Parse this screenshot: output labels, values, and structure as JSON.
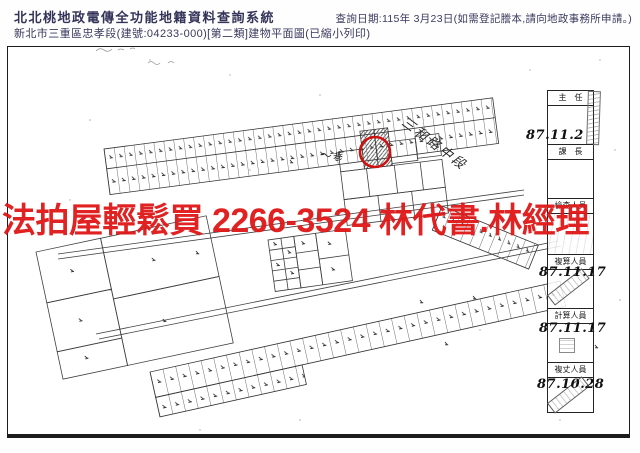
{
  "header": {
    "system_title": "北北桃地政電傳全功能地籍資料查詢系統",
    "document_subtitle": "新北市三重區忠孝段(建號:04233-000)[第二類]建物平面圖(已縮小列印)",
    "query_date": "查詢日期:115年 3月23日(如需登記謄本,請向地政事務所申請。)"
  },
  "watermark": {
    "text": "法拍屋輕鬆買 2266-3524 林代書.林經理",
    "color": "#df1717"
  },
  "map": {
    "annotations": {
      "road_label": "三和路中段",
      "lane_label": "巷"
    },
    "highlight_color": "#cd1212",
    "line_color": "#3f3f3f"
  },
  "stamp_panel": {
    "rows": [
      {
        "title": "主　任",
        "date": "87.11.2"
      },
      {
        "title": "課　長",
        "date": ""
      },
      {
        "title": "檢查人員",
        "date": ""
      },
      {
        "title": "複算人員",
        "date": "87.11.17"
      },
      {
        "title": "計算人員",
        "date": "87.11.17"
      },
      {
        "title": "複丈人員",
        "date": "87.10.28"
      }
    ]
  }
}
